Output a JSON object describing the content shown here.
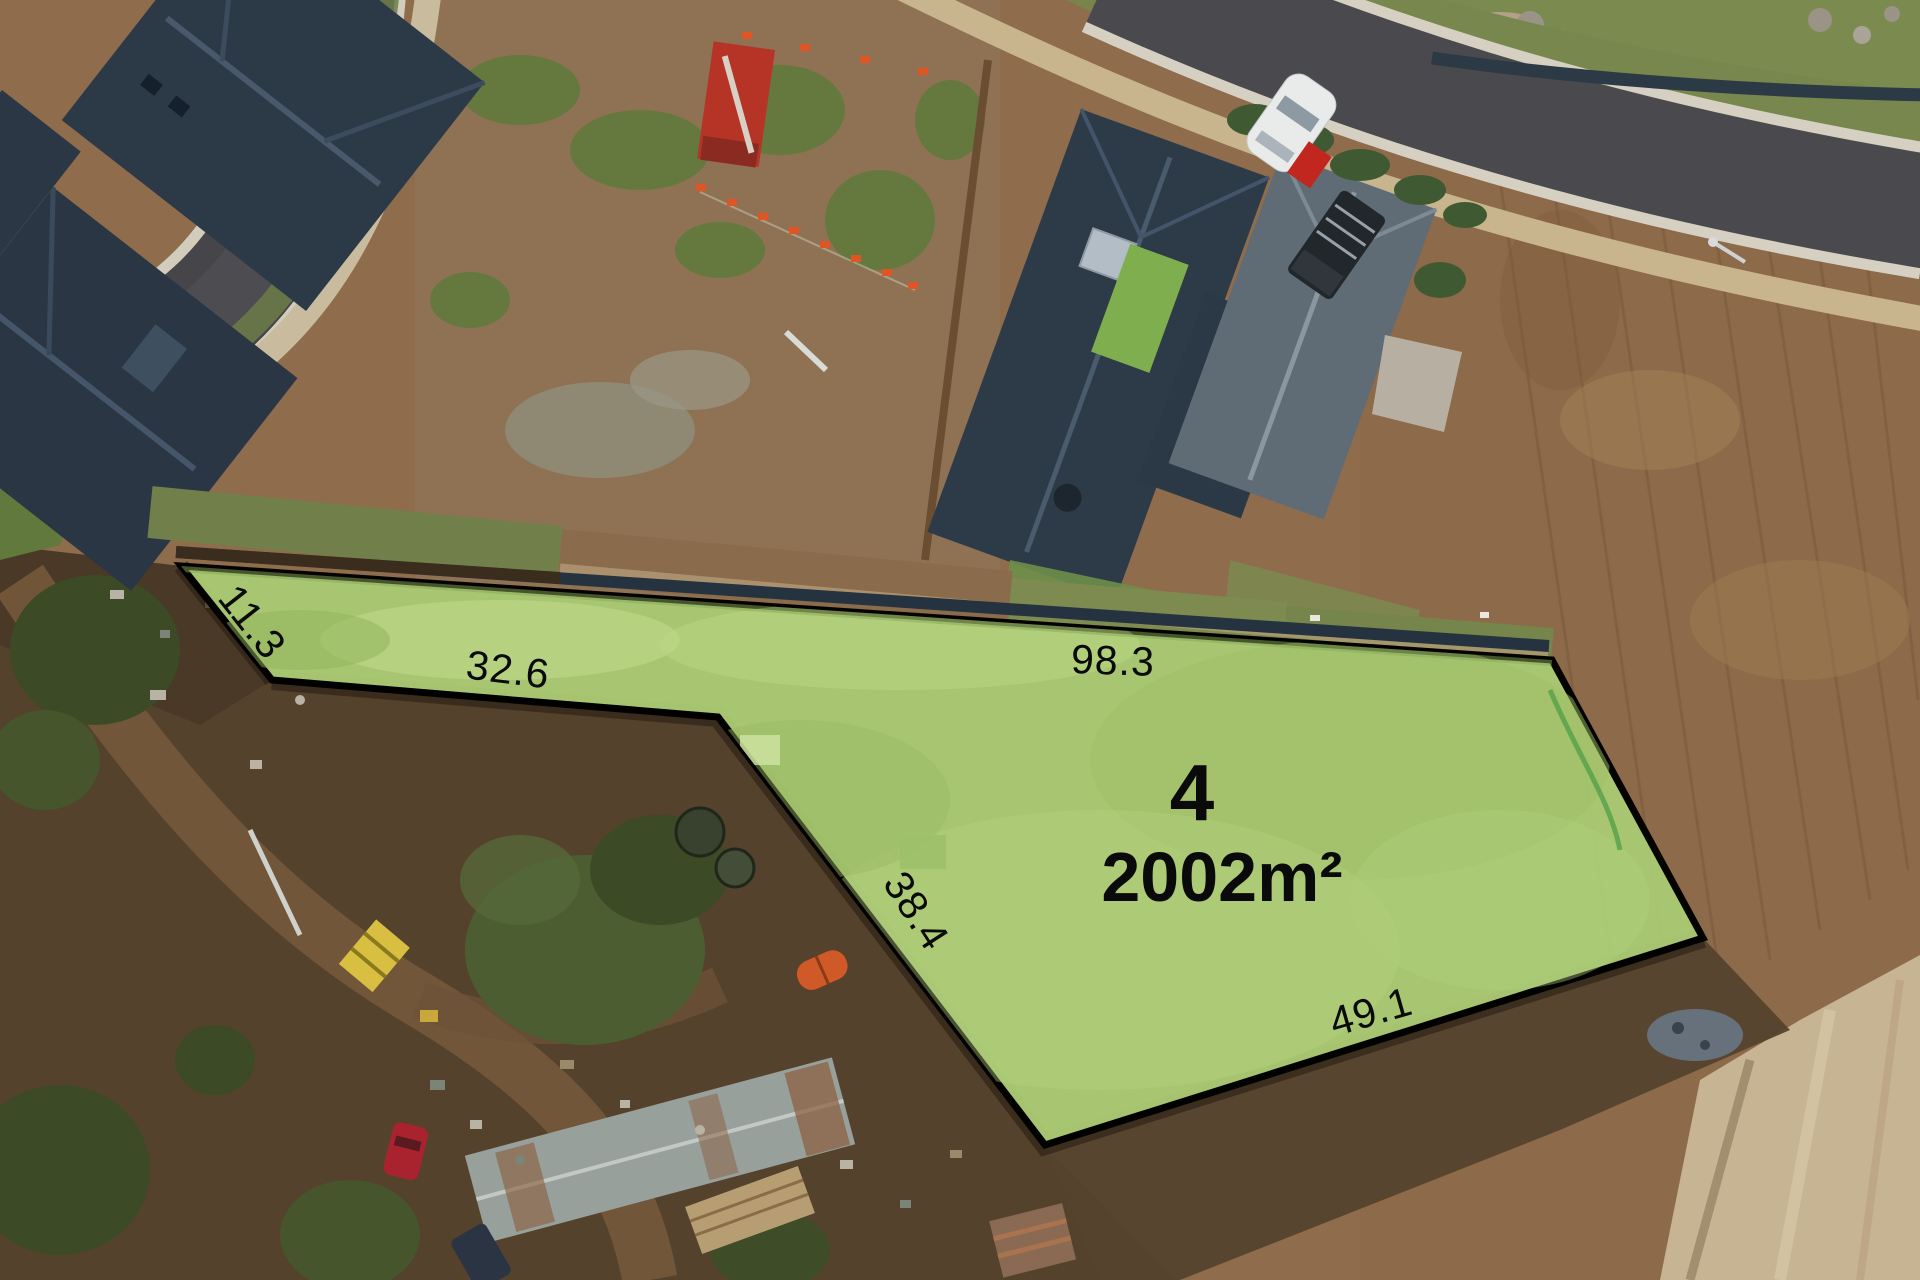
{
  "lot": {
    "number": "4",
    "area": "2002m²",
    "boundary_lengths": [
      {
        "value": "11.3"
      },
      {
        "value": "32.6"
      },
      {
        "value": "98.3"
      },
      {
        "value": "38.4"
      },
      {
        "value": "49.1"
      }
    ]
  },
  "colors": {
    "lot_fill": "#a9c973",
    "lot_boundary": "#000000",
    "label_text": "#0a0a0a"
  }
}
